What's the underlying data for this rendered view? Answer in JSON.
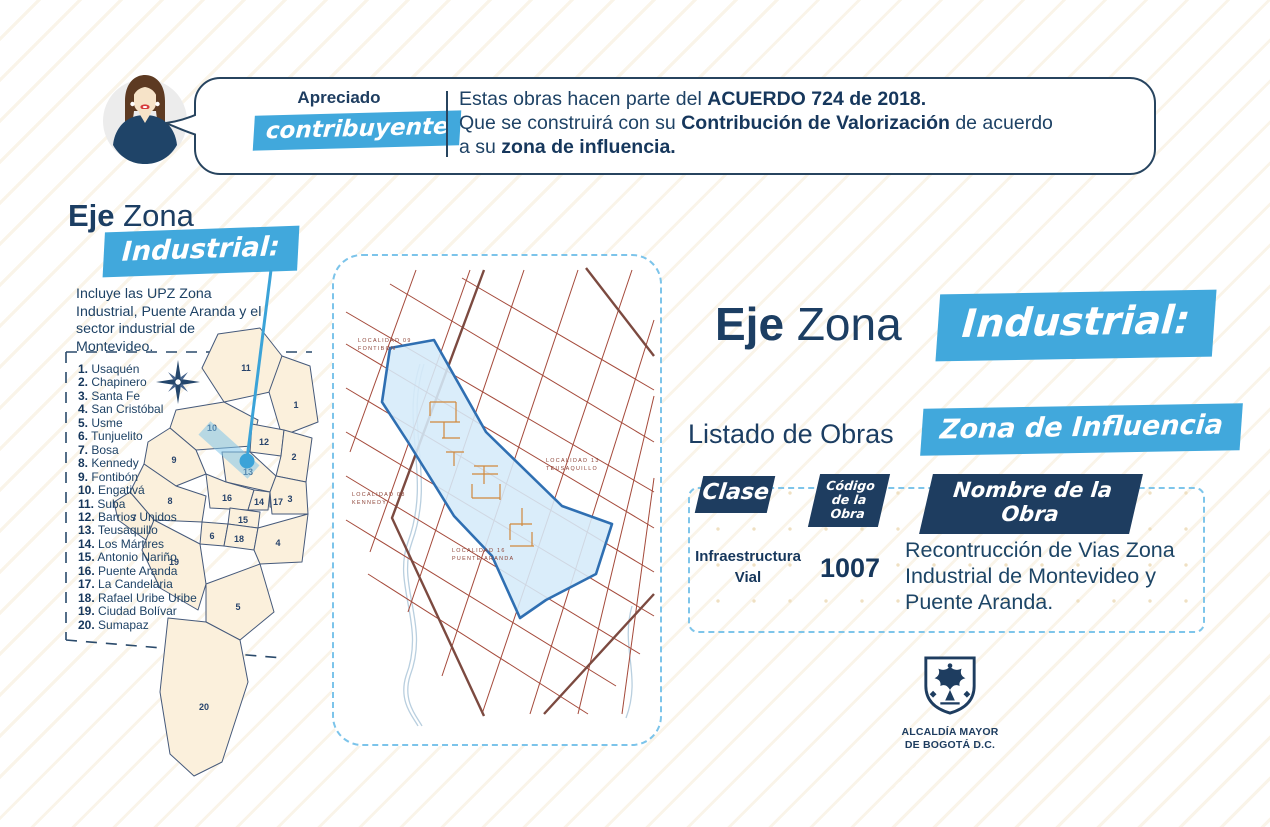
{
  "colors": {
    "navy": "#1e3d60",
    "text_navy": "#1e4265",
    "blue_accent": "#41a8dc",
    "dash_blue": "#7cc4ea",
    "map_cream": "#fbf0dc",
    "street_red": "#a4493a",
    "zone_fill": "#d5eaf9",
    "zone_border": "#2f6fb2"
  },
  "header": {
    "greeting_top": "Apreciado",
    "greeting_badge": "contribuyente",
    "line1_pre": "Estas obras hacen parte del ",
    "line1_bold": "ACUERDO 724 de 2018.",
    "line2_pre": "Que se construirá con su ",
    "line2_bold": "Contribución de Valorización",
    "line2_post": " de acuerdo",
    "line3_pre": "a su ",
    "line3_bold": "zona de influencia."
  },
  "left": {
    "title_bold": "Eje",
    "title_light": "Zona",
    "title_badge": "Industrial:",
    "description": "Incluye las UPZ Zona Industrial, Puente Aranda y el sector industrial de Montevideo.",
    "localities": [
      {
        "num": "1.",
        "name": "Usaquén"
      },
      {
        "num": "2.",
        "name": "Chapinero"
      },
      {
        "num": "3.",
        "name": "Santa Fe"
      },
      {
        "num": "4.",
        "name": "San Cristóbal"
      },
      {
        "num": "5.",
        "name": "Usme"
      },
      {
        "num": "6.",
        "name": "Tunjuelito"
      },
      {
        "num": "7.",
        "name": "Bosa"
      },
      {
        "num": "8.",
        "name": "Kennedy"
      },
      {
        "num": "9.",
        "name": "Fontibón"
      },
      {
        "num": "10.",
        "name": "Engativá"
      },
      {
        "num": "11.",
        "name": "Suba"
      },
      {
        "num": "12.",
        "name": "Barrios Unidos"
      },
      {
        "num": "13.",
        "name": "Teusaquillo"
      },
      {
        "num": "14.",
        "name": "Los Mártires"
      },
      {
        "num": "15.",
        "name": "Antonio Nariño"
      },
      {
        "num": "16.",
        "name": "Puente Aranda"
      },
      {
        "num": "17.",
        "name": "La Candelaria"
      },
      {
        "num": "18.",
        "name": "Rafael Uribe Uribe"
      },
      {
        "num": "19.",
        "name": "Ciudad Bolívar"
      },
      {
        "num": "20.",
        "name": "Sumapaz"
      }
    ],
    "map_numbers": [
      "1",
      "2",
      "3",
      "4",
      "5",
      "6",
      "7",
      "8",
      "9",
      "10",
      "11",
      "12",
      "13",
      "14",
      "15",
      "16",
      "17",
      "18",
      "19",
      "20"
    ]
  },
  "street_map": {
    "labels": {
      "l09a": "LOCALIDAD 09",
      "l09b": "FONTIBON",
      "l13a": "LOCALIDAD 13",
      "l13b": "TEUSAQUILLO",
      "l16a": "LOCALIDAD 16",
      "l16b": "PUENTE ARANDA",
      "l08a": "LOCALIDAD 08",
      "l08b": "KENNEDY"
    }
  },
  "right": {
    "title_bold": "Eje",
    "title_light": "Zona",
    "title_badge": "Industrial:",
    "listado_label": "Listado de Obras",
    "zona_badge": "Zona de Influencia",
    "table": {
      "header_clase": "Clase",
      "header_codigo": "Código de la Obra",
      "header_nombre": "Nombre de la Obra",
      "row": {
        "clase": "Infraestructura Vial",
        "codigo": "1007",
        "nombre": "Recontrucción de Vias Zona Industrial de Montevideo y Puente Aranda."
      }
    }
  },
  "logo": {
    "line1": "ALCALDÍA MAYOR",
    "line2": "DE BOGOTÁ D.C."
  }
}
